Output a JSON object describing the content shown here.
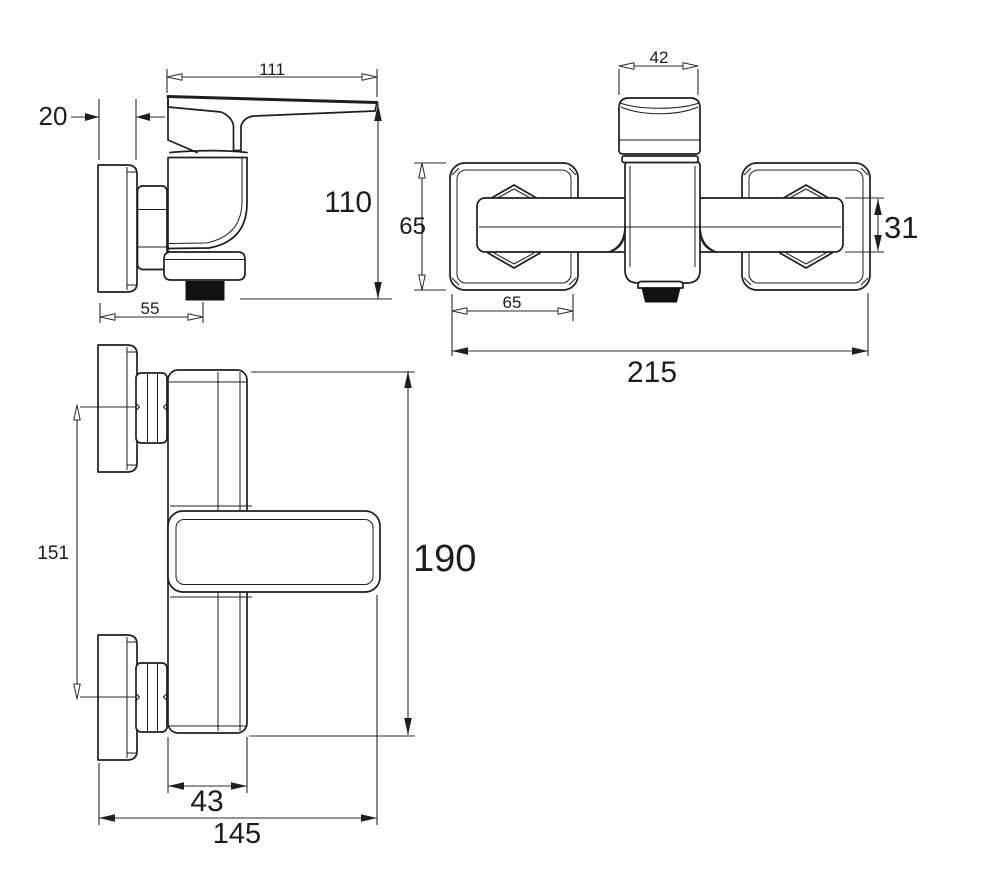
{
  "drawing": {
    "type": "faucet-technical-drawing",
    "colors": {
      "line": "#1e1e1e",
      "background": "#ffffff",
      "outlet_fill": "#111111"
    }
  },
  "views": {
    "side": {
      "dims": {
        "spout_length": "111",
        "plate_thickness": "20",
        "height": "110",
        "outlet_offset": "55"
      }
    },
    "top": {
      "dims": {
        "handle_width": "42",
        "escutcheon_height": "65",
        "connection_height": "31",
        "escutcheon_width": "65",
        "overall_width": "215"
      }
    },
    "front": {
      "dims": {
        "connection_spacing": "151",
        "overall_height": "190",
        "body_width": "43",
        "overall_depth": "145"
      }
    }
  }
}
